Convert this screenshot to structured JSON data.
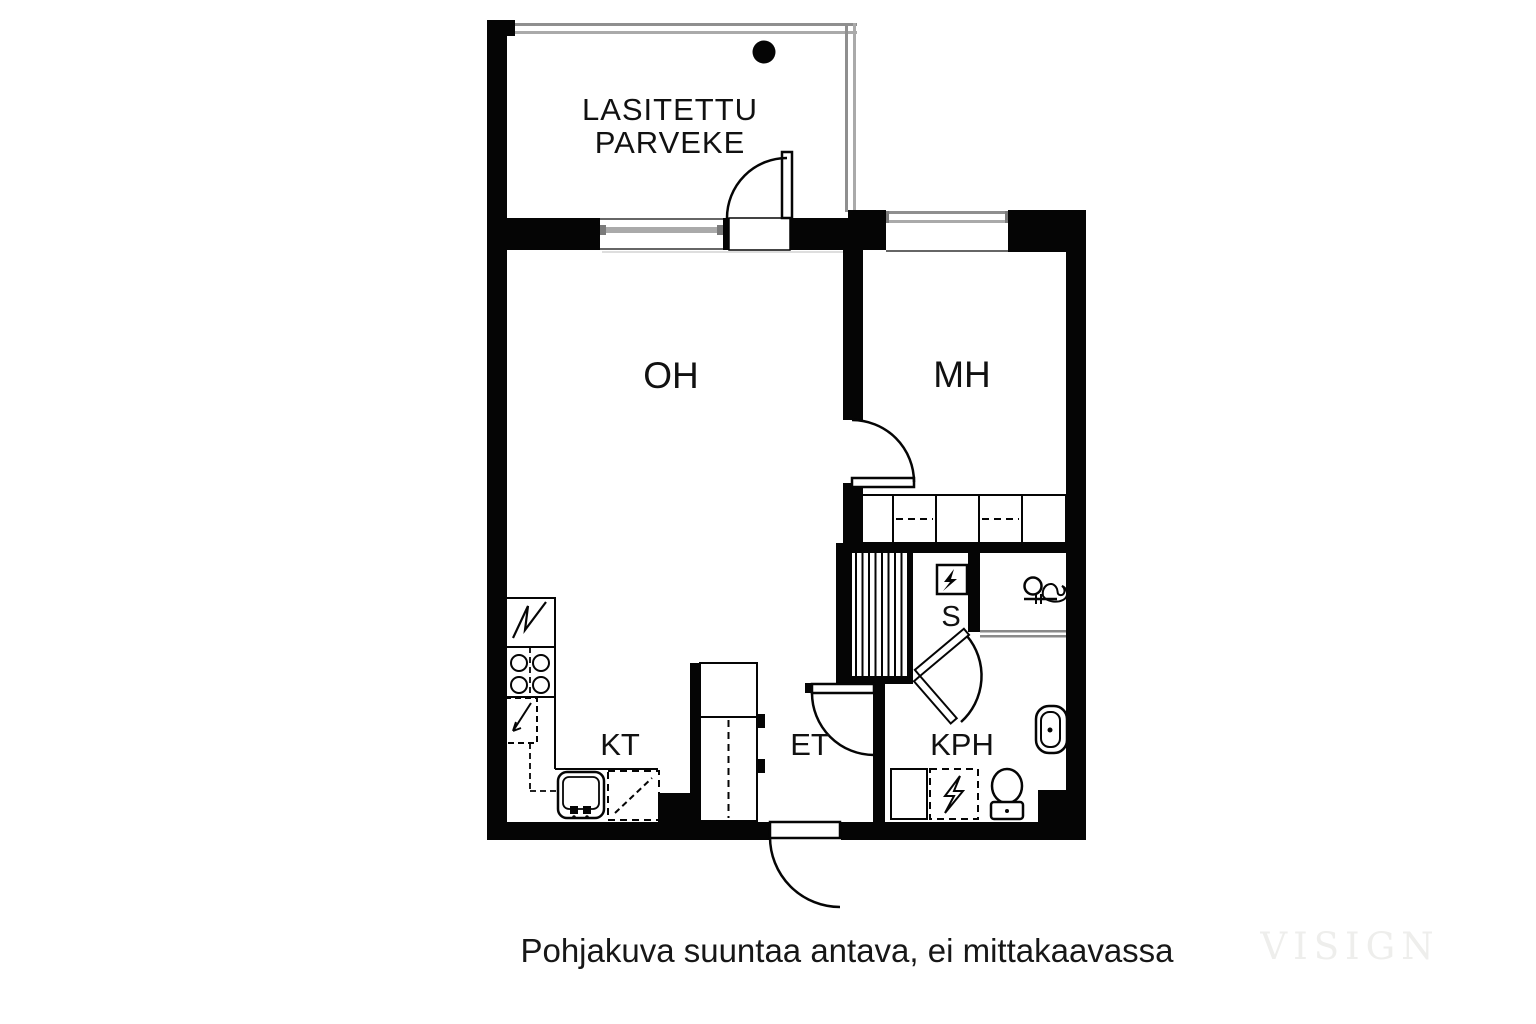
{
  "floorplan": {
    "balcony": {
      "label_line1": "LASITETTU",
      "label_line2": "PARVEKE"
    },
    "rooms": {
      "living": "OH",
      "bedroom": "MH",
      "kitchen": "KT",
      "entry": "ET",
      "bathroom": "KPH",
      "sauna": "S"
    },
    "caption": "Pohjakuva suuntaa antava, ei mittakaavassa",
    "watermark": "VISIGN",
    "colors": {
      "wall": "#050505",
      "background": "#ffffff",
      "glazing_gray": "#8f8f8f",
      "watermark_gray": "#eeeeec"
    }
  }
}
